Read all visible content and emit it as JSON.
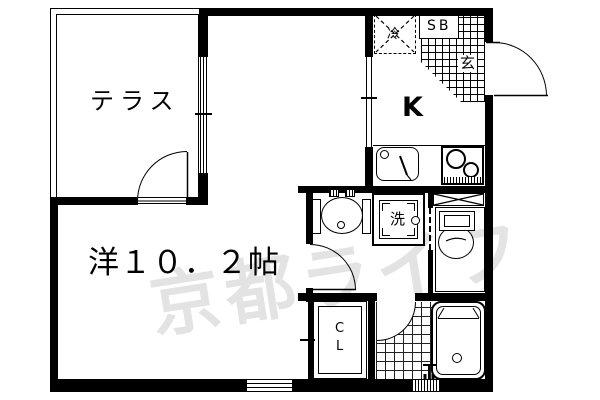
{
  "watermark": {
    "text": "京都ライフ",
    "color": "#e3e3e3"
  },
  "labels": {
    "terrace": "テラス",
    "main_room": "洋１０．２帖",
    "kitchen": "K",
    "refrigerator": "冷",
    "shoe_box": "SB",
    "entrance": "玄",
    "washing_machine": "洗",
    "closet_line1": "C",
    "closet_line2": "L"
  },
  "colors": {
    "line": "#000000",
    "floor": "#ffffff",
    "watermark": "#e3e3e3"
  }
}
